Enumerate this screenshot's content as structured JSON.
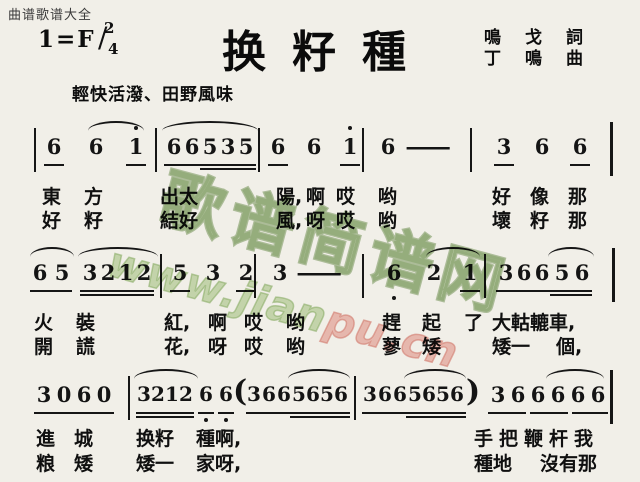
{
  "header": {
    "site": "曲谱歌谱大全",
    "key": "1=F",
    "time_top": "2",
    "time_slash": "/",
    "time_bottom": "4",
    "title": "换籽種",
    "credit1": "鳴戈詞",
    "credit2": "丁鳴曲",
    "tempo": "輕快活潑、田野風味"
  },
  "watermark": {
    "brand": "歌谱简谱网",
    "url_green": "www.jian",
    "url_pink": "pu.cn"
  },
  "score": {
    "l1n": [
      "6",
      "6",
      "1",
      "6",
      "6",
      "5",
      "3",
      "5",
      "6",
      "6",
      "1",
      "6",
      "—",
      "3",
      "6",
      "6"
    ],
    "l2n": [
      "6",
      "5",
      "3",
      "2",
      "1",
      "2",
      "5",
      "3",
      "2",
      "3",
      "—",
      "6",
      "2",
      "1",
      "3",
      "6",
      "6",
      "5",
      "6"
    ],
    "l3n": [
      "3",
      "0",
      "6",
      "0",
      "3",
      "2",
      "1",
      "2",
      "6",
      "6",
      "(",
      "3",
      "6",
      "6",
      "5",
      "6",
      "5",
      "6",
      "3",
      "6",
      "6",
      "5",
      "6",
      "5",
      "6",
      ")",
      "3",
      "6",
      "6",
      "6",
      "6",
      "6"
    ],
    "l1a": [
      "東",
      "方",
      "出太",
      "陽,",
      "啊",
      "哎",
      "哟",
      "好",
      "像",
      "那"
    ],
    "l1b": [
      "好",
      "籽",
      "結好",
      "風,",
      "呀",
      "哎",
      "哟",
      "壞",
      "籽",
      "那"
    ],
    "l2a": [
      "火",
      "裝",
      "紅,",
      "啊",
      "哎",
      "哟",
      "趕",
      "起",
      "了",
      "大軲轆車,"
    ],
    "l2b": [
      "開",
      "謊",
      "花,",
      "呀",
      "哎",
      "哟",
      "蓼",
      "矮",
      "矮一",
      "個,"
    ],
    "l3a": [
      "進",
      "城",
      "换籽",
      "種啊,",
      "手把鞭杆我"
    ],
    "l3b": [
      "粮",
      "矮",
      "矮一",
      "家呀,",
      "種地",
      "沒有那"
    ]
  }
}
